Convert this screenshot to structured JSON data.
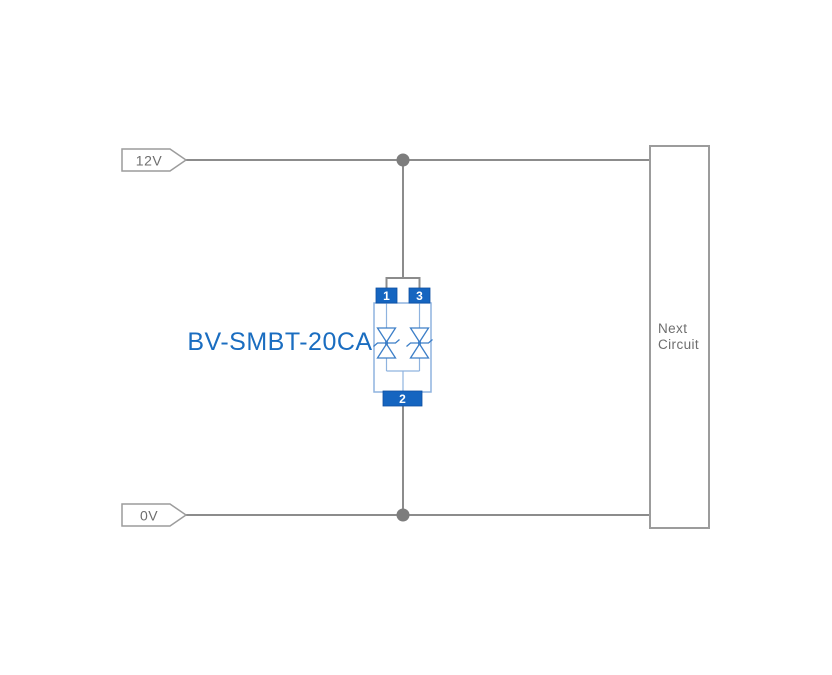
{
  "diagram": {
    "component_label": "BV-SMBT-20CA",
    "rails": {
      "top_label": "12V",
      "bottom_label": "0V"
    },
    "component": {
      "pin_top_left": "1",
      "pin_top_right": "3",
      "pin_bottom": "2"
    },
    "next_circuit": {
      "line1": "Next",
      "line2": "Circuit"
    },
    "colors": {
      "wire_gray": "#8c8c8c",
      "junction_gray": "#7d7d7d",
      "outline_gray": "#9c9c9c",
      "text_gray": "#6e6e6e",
      "pin_blue": "#1565c0",
      "pin_border_blue": "#0d4fa0",
      "body_outline_blue": "#8fb3df",
      "diode_blue": "#3d7fc8",
      "label_blue": "#1a6dc0",
      "background": "#ffffff"
    }
  }
}
